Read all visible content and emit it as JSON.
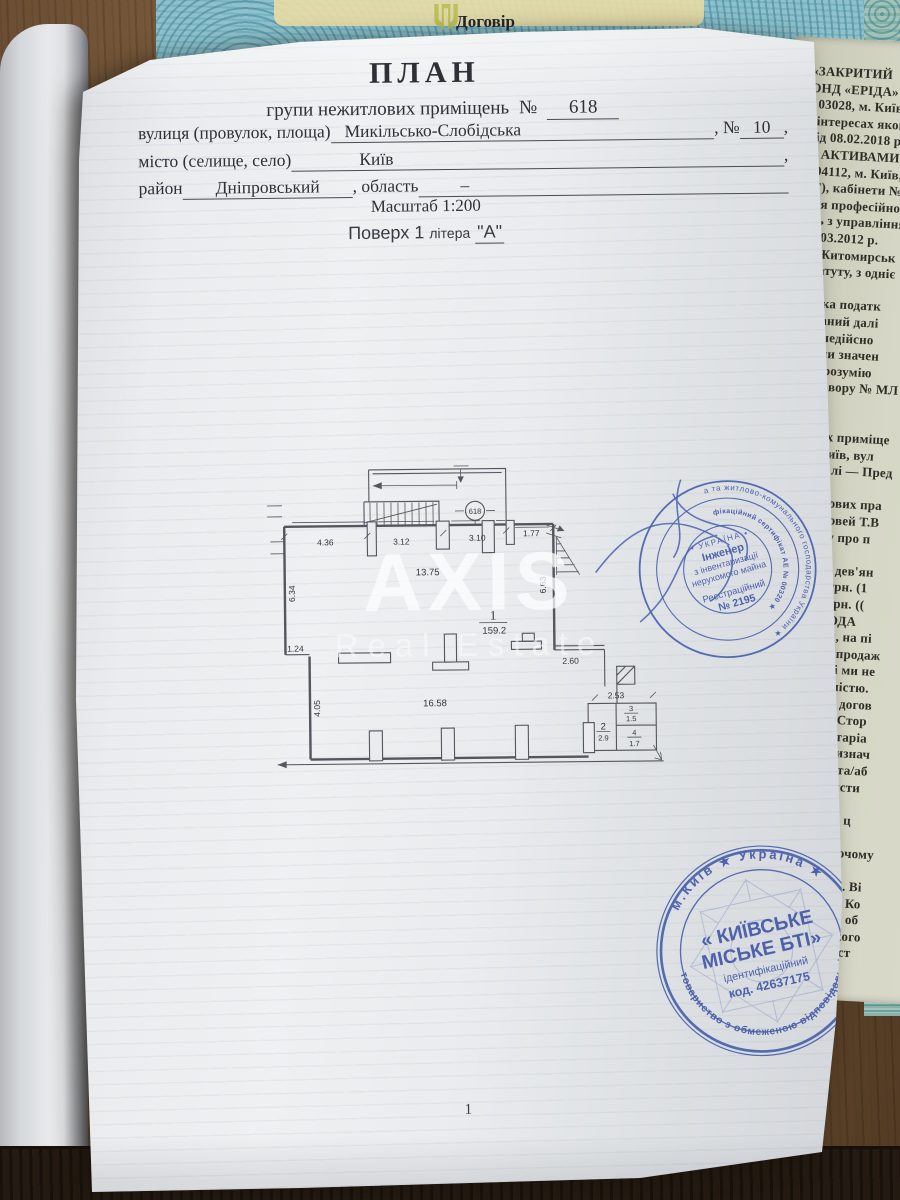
{
  "top_document": {
    "title": "Договір"
  },
  "document": {
    "title": "ПЛАН",
    "subtitle_prefix": "групи нежитлових приміщень",
    "number_label": "№",
    "number": "618",
    "street_label": "вулиця (провулок, площа)",
    "street_value": "Микільсько-Слобідська",
    "street_no_label": ", №",
    "street_no": "10",
    "comma": ",",
    "city_label": "місто (селище, село)",
    "city_value": "Київ",
    "district_label": "район",
    "district_value": "Дніпровський",
    "oblast_label": ", область",
    "oblast_value": "–",
    "scale_line": "Масштаб 1:200",
    "floor_prefix": "Поверх 1",
    "floor_litera": "літера",
    "floor_value": "\"А\"",
    "page_number": "1"
  },
  "watermark": {
    "line1": "AXIS",
    "line2": "Real Estate"
  },
  "plan": {
    "unit_number": "618",
    "dims": {
      "top": [
        "4.36",
        "3.12",
        "3.10",
        "1.77"
      ],
      "top_width": "13.75",
      "left_height": "6.34",
      "left_step": "1.24",
      "left_lower": "4.05",
      "right_height": "6.63",
      "right_bottom": "2.60",
      "cluster_top": "2.53",
      "bottom_width": "16.58"
    },
    "rooms": [
      {
        "number": "1",
        "area": "159.2"
      },
      {
        "number": "2",
        "area": "2.9"
      },
      {
        "number": "3",
        "area": "1.5"
      },
      {
        "number": "4",
        "area": "1.7"
      }
    ]
  },
  "stamps": {
    "inspector": {
      "ring_outer": "★ Міністерство регіонального розвитку, будівництва та житлово-комунального господарства України ★",
      "ring_inner": "ЦЬКИЙ ВАДИМ ВАЛЕРІЙОВИЧ ★ кваліфікаційний сертифікат АЕ № 00320 ★",
      "center_country": "• УКРАЇНА •",
      "center_role1": "Інженер",
      "center_role2": "з інвентаризації",
      "center_role3": "нерухомого майна",
      "center_reg1": "Реєстраційний",
      "center_reg2": "№ 2195"
    },
    "bti": {
      "ring_top": "м.Київ ★ Україна ★",
      "ring_bottom": "товариство з обмеженою відповідальністю",
      "center_name1": "« КИЇВСЬКЕ",
      "center_name2": "МІСЬКЕ БТІ»",
      "center_id1": "ідентифікаційний",
      "center_id2": "код. 42637175"
    }
  },
  "side_document": {
    "lines": [
      "«ЗАКРИТИЙ",
      "ОНД «ЕРІДА»",
      "; 03028, м. Київ,",
      "і інтересах якого",
      "від 08.02.2018 р.",
      "Я АКТИВАМИ",
      ": 04112, м. Київ,",
      ". Г), кабінети №",
      "ння професійної",
      "сть з управління",
      "26.03.2012 р.",
      "о: Житомирськ",
      "Статуту, з одніє",
      "",
      "тника податк",
      "нований далі",
      "одо недійсно",
      "міючи значен",
      "роз, розумію",
      "овору № МЛ",
      "а",
      "",
      "их приміще",
      "Київ, вул",
      "далі — Пред",
      "",
      "ечових пра",
      "оловей Т.В",
      "ису про п",
      "",
      "ста дев'ян",
      "00 грн. (1",
      "00 грн. ((",
      "ПРОДА",
      "м, на пі",
      "у продаж",
      "є і ми не",
      "вністю.",
      "ет догов",
      "и. Стор",
      "нотаріа",
      "признач",
      "ру та/аб",
      "еристи",
      "",
      "я за ц",
      "",
      "бочому",
      "",
      "ає. Ві",
      "гу Ко",
      "ть об",
      "ького",
      "еєст"
    ]
  },
  "colors": {
    "stamp_blue": "#3c55a8",
    "paper": "#e9ebee",
    "wood": "#5a4129",
    "notary_blank_teal": "#8fc0cb",
    "ink": "#2f2f36"
  }
}
